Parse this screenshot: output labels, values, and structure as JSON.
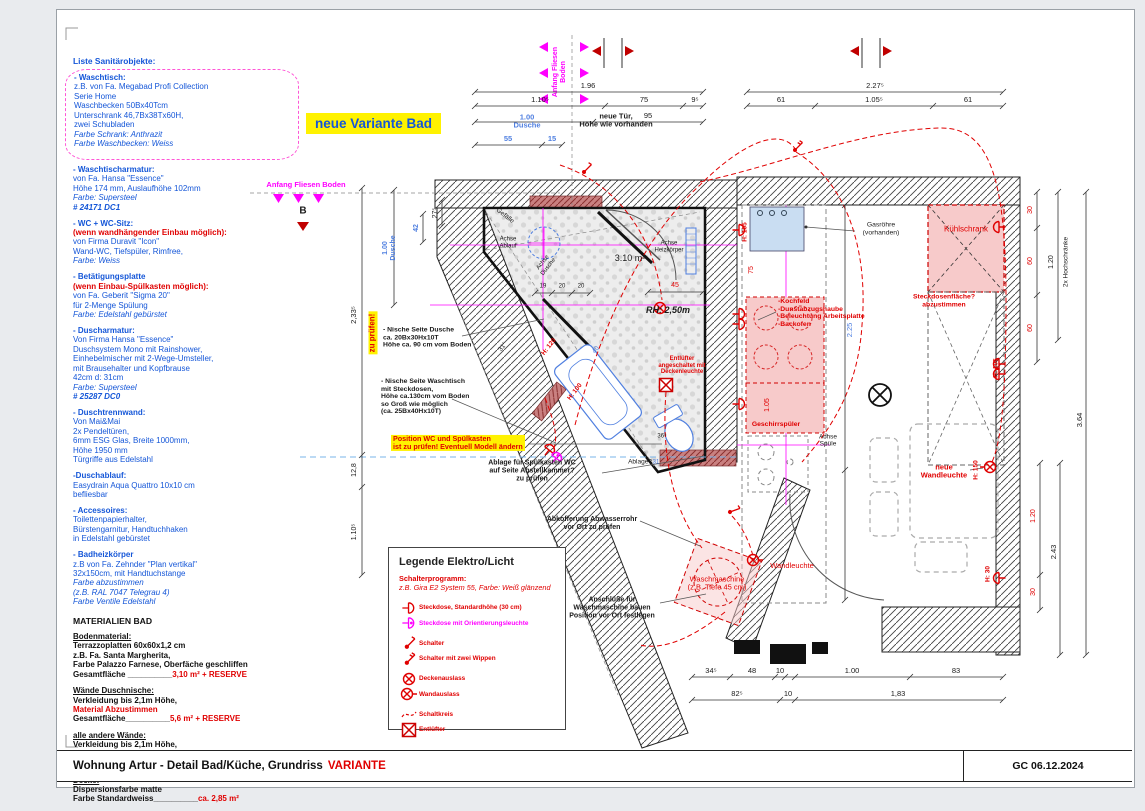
{
  "sheet": {
    "title_left": "Wohnung Artur - Detail Bad/Küche, Grundriss",
    "title_variant": "VARIANTE",
    "date": "GC 06.12.2024"
  },
  "plan": {
    "title": "neue Variante Bad"
  },
  "colors": {
    "blue": "#1456d8",
    "dim_blue": "#4f7fe0",
    "red": "#e00000",
    "magenta": "#ff00ff",
    "highlight_yellow": "#fff200"
  },
  "sanitary": {
    "heading": "Liste Sanitärobjekte:",
    "items": [
      {
        "title": "- Waschtisch:",
        "body": "z.B. von Fa. Megabad Profi Collection\nSerie Home\nWaschbecken 50Bx40Tcm\nUnterschrank 46,7Bx38Tx60H,\nzwei Schubladen",
        "italic": "Farbe Schrank: Anthrazit\nFarbe Waschbecken: Weiss"
      },
      {
        "title": "- Waschtischarmatur:",
        "body": "von Fa. Hansa \"Essence\"\nHöhe 174 mm, Auslaufhöhe 102mm",
        "italic": "Farbe: Supersteel",
        "bold_italic": "# 24171 DC1"
      },
      {
        "title": "- WC + WC-Sitz:",
        "red": "(wenn wandhängender Einbau möglich):",
        "body": "von Firma Duravit \"Icon\"\nWand-WC, Tiefspüler, Rimfree,",
        "italic": "Farbe: Weiss"
      },
      {
        "title": "- Betätigungsplatte",
        "red": "(wenn Einbau-Spülkasten möglich):",
        "body": "von Fa. Geberit \"Sigma 20\"\nfür 2-Menge Spülung",
        "italic": "Farbe: Edelstahl gebürstet"
      },
      {
        "title": "- Duscharmatur:",
        "body": "Von Firma Hansa \"Essence\"\nDuschsystem Mono mit Rainshower,\nEinhebelmischer mit 2-Wege-Umsteller,\nmit Brausehalter und Kopfbrause\n42cm d: 31cm",
        "italic": "Farbe: Supersteel",
        "bold_italic": "# 25287 DC0"
      },
      {
        "title": "- Duschtrennwand:",
        "body": "Von Mai&Mai\n2x Pendeltüren,\n6mm ESG Glas, Breite 1000mm,\nHöhe 1950 mm\nTürgriffe aus Edelstahl"
      },
      {
        "title": "-Duschablauf:",
        "body": "Easydrain Aqua Quattro 10x10 cm\nbefliesbar"
      },
      {
        "title": "- Accessoires:",
        "body": "Toilettenpapierhalter,\nBürstengarnitur, Handtuchhaken\nin Edelstahl gebürstet"
      },
      {
        "title": "- Badheizkörper",
        "body": "z.B von Fa. Zehnder \"Plan vertikal\"\n32x150cm, mit Handtuchstange",
        "italic": "Farbe abzustimmen\n(z.B. RAL 7047 Telegrau 4)\nFarbe Ventile Edelstahl"
      }
    ]
  },
  "materials": {
    "heading": "MATERIALIEN BAD",
    "sections": [
      {
        "heading": "Bodenmaterial:",
        "body": "Terrazzoplatten 60x60x1,2 cm\nz.B. Fa. Santa Margherita,\nFarbe Palazzo Farnese, Oberfäche geschliffen",
        "total_label": "Gesamtfläche __________",
        "total_value": "3,10 m² + RESERVE"
      },
      {
        "heading": "Wände Duschnische:",
        "body": "Verkleidung bis 2,1m Höhe,",
        "red_line": "Material Abzustimmen",
        "total_label": "Gesamtfläche__________",
        "total_value": "5,6 m² + RESERVE"
      },
      {
        "heading": "alle andere Wände:",
        "body": "Verkleidung bis 2,1m Höhe,",
        "red_line": "Material Abzustimmen",
        "total_label": "Gesamtfläche__________",
        "total_value": "ca. 11,5 m² + RESERVE"
      },
      {
        "heading": "Decke:",
        "body": "Dispersionsfarbe matte",
        "total_label": "Farbe Standardweiss__________",
        "total_value": "ca. 2,85 m²"
      }
    ]
  },
  "legend": {
    "title": "Legende Elektro/Licht",
    "subtitle": "Schalterprogramm:",
    "subtitle2": "z.B. Gira E2 System 55, Farbe: Weiß glänzend",
    "items": [
      {
        "icon": "socket-icon",
        "label": "Steckdose, Standardhöhe (30 cm)"
      },
      {
        "icon": "socket-orientation-light-icon",
        "label": "Steckdose mit Orientierungsleuchte"
      },
      {
        "icon": "switch-icon",
        "label": "Schalter"
      },
      {
        "icon": "switch-two-rockers-icon",
        "label": "Schalter mit zwei Wippen"
      },
      {
        "icon": "ceiling-outlet-icon",
        "label": "Deckenauslass"
      },
      {
        "icon": "wall-outlet-icon",
        "label": "Wandauslass"
      },
      {
        "icon": "circuit-line-icon",
        "label": "Schaltkreis"
      },
      {
        "icon": "exhaust-fan-icon",
        "label": "Entlüfter"
      }
    ]
  },
  "plan_texts": [
    {
      "n": "label-anfang-fliesen-top",
      "t": "Anfang Fliesen\nBoden",
      "x": 560,
      "y": 72,
      "c": "m bd",
      "s": 7,
      "r": -90
    },
    {
      "n": "label-anfang-fliesen-left",
      "t": "Anfang Fliesen Boden",
      "x": 306,
      "y": 185,
      "c": "m bd",
      "s": 7.5
    },
    {
      "n": "label-neue-tuer",
      "t": "neue Tür,\nHöhe wie vorhanden",
      "x": 616,
      "y": 121,
      "c": "k bd",
      "s": 7.5
    },
    {
      "t": "1.96",
      "x": 588,
      "y": 86
    },
    {
      "t": "1.10⁵",
      "x": 540,
      "y": 100
    },
    {
      "t": "75",
      "x": 644,
      "y": 100
    },
    {
      "t": "9⁵",
      "x": 695,
      "y": 100
    },
    {
      "t": "1.00\nDusche",
      "x": 527,
      "y": 122,
      "c": "db bd"
    },
    {
      "t": "95",
      "x": 648,
      "y": 116
    },
    {
      "t": "55",
      "x": 508,
      "y": 139,
      "c": "db bd"
    },
    {
      "t": "15",
      "x": 552,
      "y": 139,
      "c": "db bd"
    },
    {
      "t": "2.27⁵",
      "x": 875,
      "y": 86
    },
    {
      "t": "61",
      "x": 781,
      "y": 100
    },
    {
      "t": "1.05⁵",
      "x": 874,
      "y": 100
    },
    {
      "t": "61",
      "x": 968,
      "y": 100
    },
    {
      "t": "2,33⁵",
      "x": 354,
      "y": 315,
      "r": -90
    },
    {
      "n": "note-zu-pruefen",
      "t": "zu prüfen!",
      "x": 373,
      "y": 333,
      "c": "r bd bgy",
      "s": 8,
      "r": -90
    },
    {
      "t": "1.00\nDusche",
      "x": 390,
      "y": 248,
      "c": "db bd",
      "s": 7,
      "r": -90
    },
    {
      "t": "42",
      "x": 417,
      "y": 228,
      "c": "db bd",
      "s": 7,
      "r": -90
    },
    {
      "t": "27⁵",
      "x": 436,
      "y": 213,
      "s": 7,
      "r": -90
    },
    {
      "t": "12,8",
      "x": 355,
      "y": 470,
      "s": 7,
      "r": -90
    },
    {
      "t": "1.10⁵",
      "x": 355,
      "y": 532,
      "s": 7,
      "r": -90
    },
    {
      "t": "30",
      "x": 1031,
      "y": 210,
      "c": "r",
      "s": 7,
      "r": -90
    },
    {
      "t": "60",
      "x": 1031,
      "y": 261,
      "c": "r",
      "s": 7,
      "r": -90
    },
    {
      "t": "60",
      "x": 1031,
      "y": 328,
      "c": "r",
      "s": 7,
      "r": -90
    },
    {
      "t": "1.20",
      "x": 1052,
      "y": 262,
      "s": 7,
      "r": -90
    },
    {
      "n": "label-hochschraenke",
      "t": "2x Hochschränke",
      "x": 1066,
      "y": 262,
      "s": 6.5,
      "r": -90
    },
    {
      "t": "3.64",
      "x": 1080,
      "y": 420,
      "s": 7.5,
      "r": -90
    },
    {
      "t": "2.43",
      "x": 1054,
      "y": 552,
      "s": 7.5,
      "r": -90
    },
    {
      "t": "1.20",
      "x": 1034,
      "y": 516,
      "c": "r",
      "s": 7,
      "r": -90
    },
    {
      "t": "30",
      "x": 1034,
      "y": 592,
      "c": "r",
      "s": 7,
      "r": -90
    },
    {
      "t": "34⁵",
      "x": 711,
      "y": 671
    },
    {
      "t": "48",
      "x": 752,
      "y": 671
    },
    {
      "t": "10",
      "x": 780,
      "y": 671
    },
    {
      "t": "1.00",
      "x": 852,
      "y": 671
    },
    {
      "t": "83",
      "x": 956,
      "y": 671
    },
    {
      "t": "82⁵",
      "x": 737,
      "y": 694
    },
    {
      "t": "10",
      "x": 788,
      "y": 694
    },
    {
      "t": "1,83",
      "x": 898,
      "y": 694
    },
    {
      "n": "label-gefaelle",
      "t": "Gefälle",
      "x": 505,
      "y": 216,
      "s": 6.5,
      "r": 38
    },
    {
      "n": "label-achse-ablauf",
      "t": "Achse\nAblauf",
      "x": 508,
      "y": 243,
      "s": 6
    },
    {
      "n": "label-achse-dusche",
      "t": "Achse\nDusche",
      "x": 546,
      "y": 265,
      "s": 6,
      "r": -52
    },
    {
      "n": "label-flaeche",
      "t": "3.10 m²",
      "x": 630,
      "y": 258,
      "s": 9
    },
    {
      "n": "label-achse-heizkoerper",
      "t": "Achse\nHeizkörper",
      "x": 669,
      "y": 247,
      "s": 6
    },
    {
      "n": "label-raumhoehe",
      "t": "RH: 2,50m",
      "x": 668,
      "y": 310,
      "c": "k bd it",
      "s": 9
    },
    {
      "t": "19",
      "x": 543,
      "y": 287,
      "s": 6
    },
    {
      "t": "20",
      "x": 562,
      "y": 287,
      "s": 6
    },
    {
      "t": "20",
      "x": 581,
      "y": 287,
      "s": 6
    },
    {
      "t": "45",
      "x": 675,
      "y": 286,
      "c": "r",
      "s": 7
    },
    {
      "t": "H: 120",
      "x": 549,
      "y": 347,
      "c": "r bd",
      "s": 6.5,
      "r": -52
    },
    {
      "t": "H: 100",
      "x": 575,
      "y": 392,
      "c": "r bd",
      "s": 6.5,
      "r": -52
    },
    {
      "t": "40",
      "x": 596,
      "y": 350,
      "c": "db",
      "s": 6.5,
      "r": -52
    },
    {
      "t": "31°",
      "x": 503,
      "y": 347,
      "s": 6.5,
      "r": -52
    },
    {
      "t": "36⁵",
      "x": 662,
      "y": 437,
      "s": 6
    },
    {
      "t": "31",
      "x": 656,
      "y": 463,
      "c": "db",
      "s": 6
    },
    {
      "n": "note-ablage-frage",
      "t": "Ablage?",
      "x": 640,
      "y": 462,
      "s": 6.5
    },
    {
      "n": "note-entluefter",
      "t": "Entlüfter\nangeschaltet mit\nDeckenleuchte",
      "x": 682,
      "y": 366,
      "c": "r bd",
      "s": 6
    },
    {
      "n": "note-nische-dusche",
      "t": "- Nische Seite Dusche\nca. 20Bx30Hx10T\nHöhe ca. 90 cm vom Boden",
      "x": 383,
      "y": 338,
      "c": "k bd left",
      "s": 6.8
    },
    {
      "n": "note-nische-waschtisch",
      "t": "- Nische Seite Waschtisch\nmit Steckdosen,\nHöhe ca.130cm vom Boden\nso Groß wie möglich\n(ca. 25Bx40Hx10T)",
      "x": 381,
      "y": 397,
      "c": "k bd left",
      "s": 6.8
    },
    {
      "n": "note-position-wc",
      "t": "Position WC und Spülkasten\nist zu prüfen! Eventuell Modell ändern",
      "x": 391,
      "y": 443,
      "c": "r bd bgy left",
      "s": 7.2
    },
    {
      "n": "note-ablage-spuelkasten",
      "t": "Ablage für Spülkasten WC\nauf Seite Abstellkammer?\nzu prüfen",
      "x": 532,
      "y": 471,
      "c": "k bd",
      "s": 7
    },
    {
      "n": "note-abkofferung",
      "t": "Abkofferung Abwasserrohr\nvor Ort zu prüfen",
      "x": 592,
      "y": 524,
      "c": "k bd",
      "s": 7
    },
    {
      "n": "note-anschluesse",
      "t": "Anschlüße für\nWaschmaschine bauen\nPosition vor Ort festlegen",
      "x": 612,
      "y": 608,
      "c": "k bd",
      "s": 7
    },
    {
      "n": "note-waschmaschine",
      "t": "Waschmaschine\n(z.B. Tiefe 45 cm)",
      "x": 717,
      "y": 584,
      "c": "r",
      "s": 7.5
    },
    {
      "n": "note-wandleuchte",
      "t": "Wandleuchte",
      "x": 792,
      "y": 566,
      "c": "r",
      "s": 7.5
    },
    {
      "n": "note-neue-wandleuchte",
      "t": "neue\nWandleuchte",
      "x": 944,
      "y": 472,
      "c": "r bd",
      "s": 7.5
    },
    {
      "n": "marker-b",
      "t": "B",
      "x": 303,
      "y": 211,
      "c": "k bd",
      "s": 10
    },
    {
      "n": "note-gasroehre",
      "t": "Gasröhre\n(vorhanden)",
      "x": 881,
      "y": 229,
      "s": 6.8
    },
    {
      "n": "note-kuehlschrank",
      "t": "Kühlschrank",
      "x": 966,
      "y": 230,
      "c": "r",
      "s": 8
    },
    {
      "n": "note-steckdosenflaeche",
      "t": "Steckdosenfläche?\nabzustimmen",
      "x": 944,
      "y": 301,
      "c": "r bd",
      "s": 6.8
    },
    {
      "n": "note-kochfeld",
      "t": "-Kochfeld\n-Dunstabzugshaube\n-Beleuchtung Arbeitsplatte\n-Backofen",
      "x": 778,
      "y": 313,
      "c": "r bd left",
      "s": 6.8
    },
    {
      "n": "label-achse-spuele",
      "t": "Achse\nSpüle",
      "x": 828,
      "y": 441,
      "s": 6.5
    },
    {
      "n": "note-geschirrspueler",
      "t": "Geschirrspüler",
      "x": 776,
      "y": 425,
      "c": "r bd",
      "s": 6.8
    },
    {
      "t": "H: 105",
      "x": 745,
      "y": 232,
      "c": "r bd",
      "s": 6.5,
      "r": -90
    },
    {
      "t": "75",
      "x": 752,
      "y": 270,
      "c": "r",
      "s": 7,
      "r": -90
    },
    {
      "t": "1.05",
      "x": 768,
      "y": 405,
      "c": "r",
      "s": 7,
      "r": -90
    },
    {
      "t": "2.25",
      "x": 850,
      "y": 330,
      "c": "db",
      "s": 7.5,
      "r": -90
    },
    {
      "t": "H: 105",
      "x": 996,
      "y": 368,
      "c": "r bd",
      "s": 6.5,
      "r": -90
    },
    {
      "t": "H: 150",
      "x": 976,
      "y": 470,
      "c": "r bd",
      "s": 6.5,
      "r": -90
    },
    {
      "t": "H: 30",
      "x": 988,
      "y": 574,
      "c": "r bd",
      "s": 6.5,
      "r": -90
    }
  ]
}
